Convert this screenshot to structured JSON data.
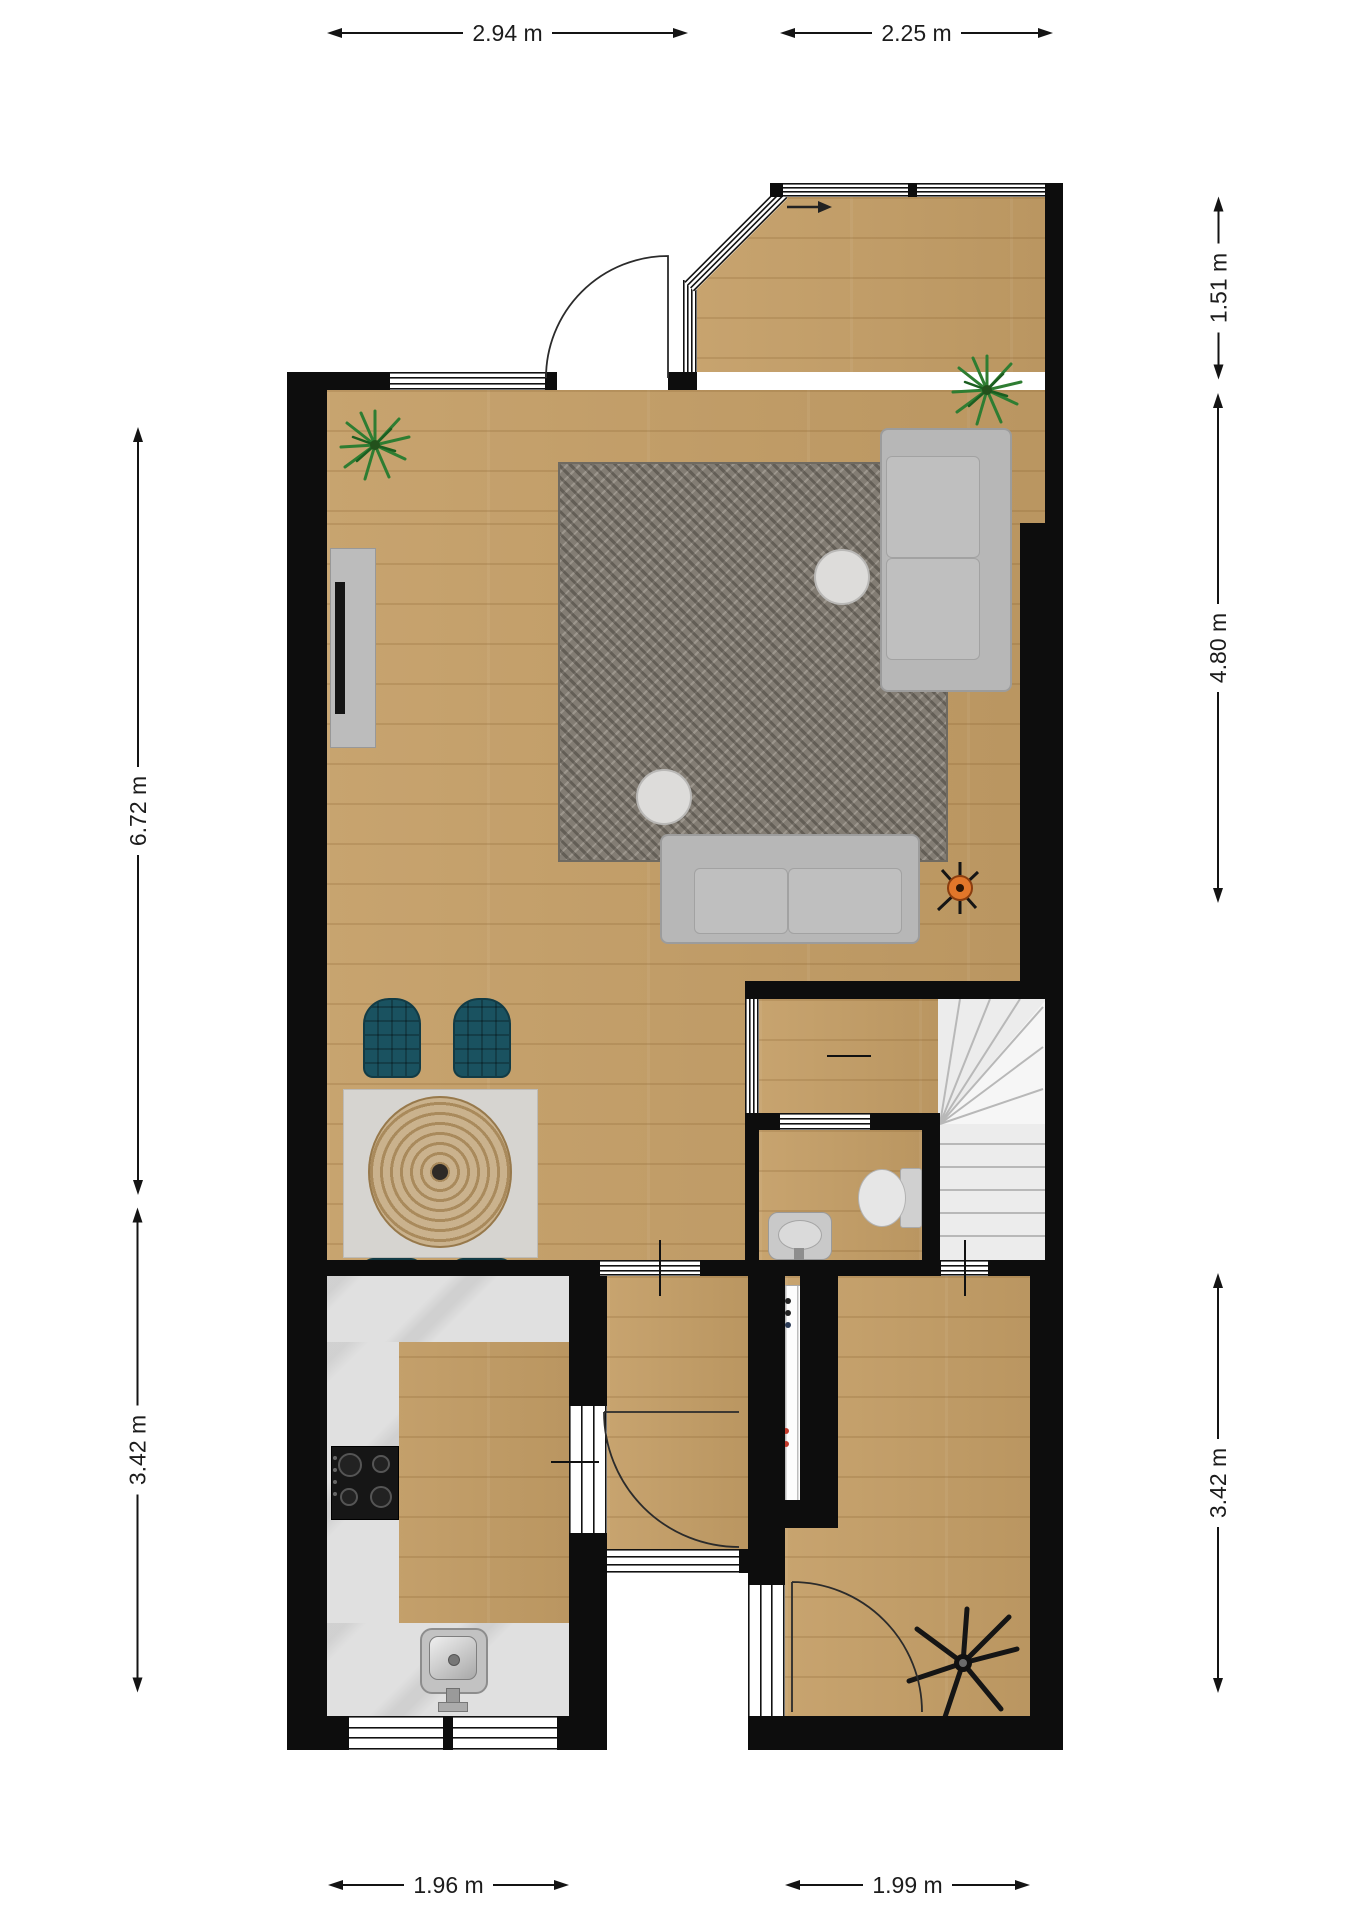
{
  "dimensions": [
    {
      "id": "top-living-width",
      "label": "2.94 m"
    },
    {
      "id": "top-bay-width",
      "label": "2.25 m"
    },
    {
      "id": "right-bay-depth",
      "label": "1.51 m"
    },
    {
      "id": "right-living-depth",
      "label": "4.80 m"
    },
    {
      "id": "right-room-depth",
      "label": "3.42 m"
    },
    {
      "id": "left-living-depth",
      "label": "6.72 m"
    },
    {
      "id": "left-kitchen-depth",
      "label": "3.42 m"
    },
    {
      "id": "bottom-kitchen-width",
      "label": "1.96 m"
    },
    {
      "id": "bottom-room-width",
      "label": "1.99 m"
    }
  ],
  "palette": {
    "wall": "#0d0d0d",
    "wood_floor": "#c49e66",
    "rug": "#837d74",
    "sofa": "#b7b7b7",
    "dining_chair": "#1a5260",
    "counter_marble": "#e0e0e0",
    "stairs": "#ececec",
    "plant_green": "#2e7d32",
    "lamp_orange": "#e2762a",
    "dimension_text": "#1c1c1c"
  }
}
